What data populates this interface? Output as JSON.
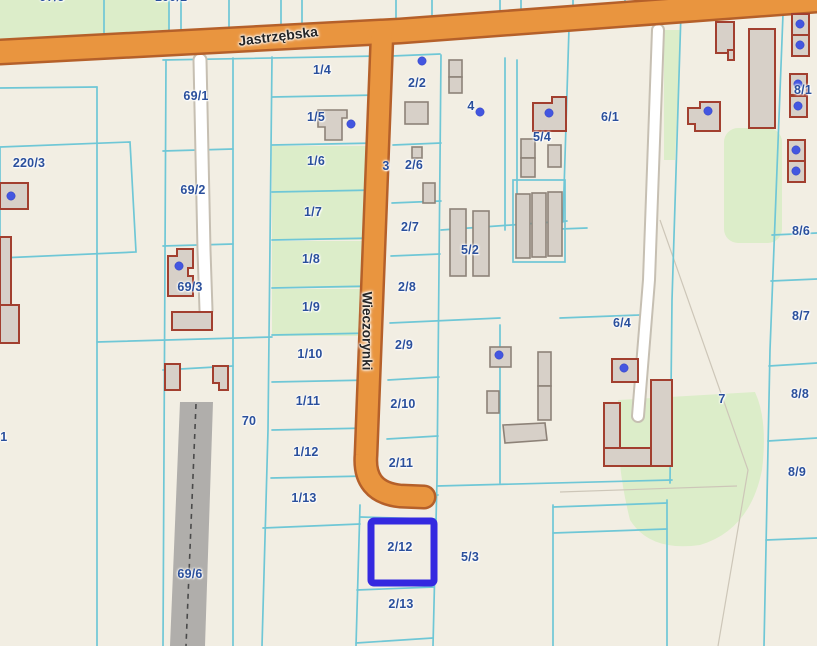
{
  "map": {
    "type": "cadastral-parcel-map",
    "street_labels": [
      {
        "name": "Jastrzębska"
      },
      {
        "name": "Wieczorynki"
      }
    ],
    "selected_parcel": {
      "label": "2/12",
      "highlight_color": "#3429e0"
    },
    "parcel_labels": [
      {
        "t": "97/5",
        "x": 52,
        "y": -3
      },
      {
        "t": "100/1",
        "x": 171,
        "y": -3
      },
      {
        "t": "1/4",
        "x": 322,
        "y": 70
      },
      {
        "t": "69/1",
        "x": 196,
        "y": 96
      },
      {
        "t": "2/2",
        "x": 417,
        "y": 83
      },
      {
        "t": "4",
        "x": 471,
        "y": 106
      },
      {
        "t": "8/1",
        "x": 803,
        "y": 90
      },
      {
        "t": "6/1",
        "x": 610,
        "y": 117
      },
      {
        "t": "1/5",
        "x": 316,
        "y": 117
      },
      {
        "t": "5/4",
        "x": 542,
        "y": 137
      },
      {
        "t": "220/3",
        "x": 29,
        "y": 163
      },
      {
        "t": "1/6",
        "x": 316,
        "y": 161
      },
      {
        "t": "2/6",
        "x": 414,
        "y": 165
      },
      {
        "t": "3",
        "x": 386,
        "y": 166
      },
      {
        "t": "69/2",
        "x": 193,
        "y": 190
      },
      {
        "t": "1/7",
        "x": 313,
        "y": 212
      },
      {
        "t": "2/7",
        "x": 410,
        "y": 227
      },
      {
        "t": "8/6",
        "x": 801,
        "y": 231
      },
      {
        "t": "5/2",
        "x": 470,
        "y": 250
      },
      {
        "t": "1/8",
        "x": 311,
        "y": 259
      },
      {
        "t": "2/8",
        "x": 407,
        "y": 287
      },
      {
        "t": "69/3",
        "x": 190,
        "y": 287
      },
      {
        "t": "1/9",
        "x": 311,
        "y": 307
      },
      {
        "t": "8/7",
        "x": 801,
        "y": 316
      },
      {
        "t": "6/4",
        "x": 622,
        "y": 323
      },
      {
        "t": "2/9",
        "x": 404,
        "y": 345
      },
      {
        "t": "1/10",
        "x": 310,
        "y": 354
      },
      {
        "t": "8/8",
        "x": 800,
        "y": 394
      },
      {
        "t": "7",
        "x": 722,
        "y": 399
      },
      {
        "t": "1/11",
        "x": 308,
        "y": 401
      },
      {
        "t": "2/10",
        "x": 403,
        "y": 404
      },
      {
        "t": "70",
        "x": 249,
        "y": 421
      },
      {
        "t": "/1",
        "x": 2,
        "y": 437
      },
      {
        "t": "1/12",
        "x": 306,
        "y": 452
      },
      {
        "t": "2/11",
        "x": 401,
        "y": 463
      },
      {
        "t": "8/9",
        "x": 797,
        "y": 472
      },
      {
        "t": "1/13",
        "x": 304,
        "y": 498
      },
      {
        "t": "2/12",
        "x": 400,
        "y": 547
      },
      {
        "t": "5/3",
        "x": 470,
        "y": 557
      },
      {
        "t": "69/6",
        "x": 190,
        "y": 574
      },
      {
        "t": "2/13",
        "x": 401,
        "y": 604
      }
    ],
    "colors": {
      "background": "#f2eee3",
      "parcel_line": "#6fc7d6",
      "faint_line": "#cdc6b8",
      "green": "#dcedc9",
      "road_fill": "#e9953f",
      "road_border": "#b5602a",
      "gray_road": "#b0aeab",
      "dash_color": "#4a4a4a",
      "path_edge": "#c6bfb2",
      "building_fill": "#d7d0c8",
      "building_outline_red": "#a23f2f",
      "building_outline_gray": "#8d8278",
      "address_dot": "#4356e0",
      "selection_blue": "#3429e0",
      "label_blue": "#2a4f9c",
      "street_text": "#262626"
    }
  }
}
